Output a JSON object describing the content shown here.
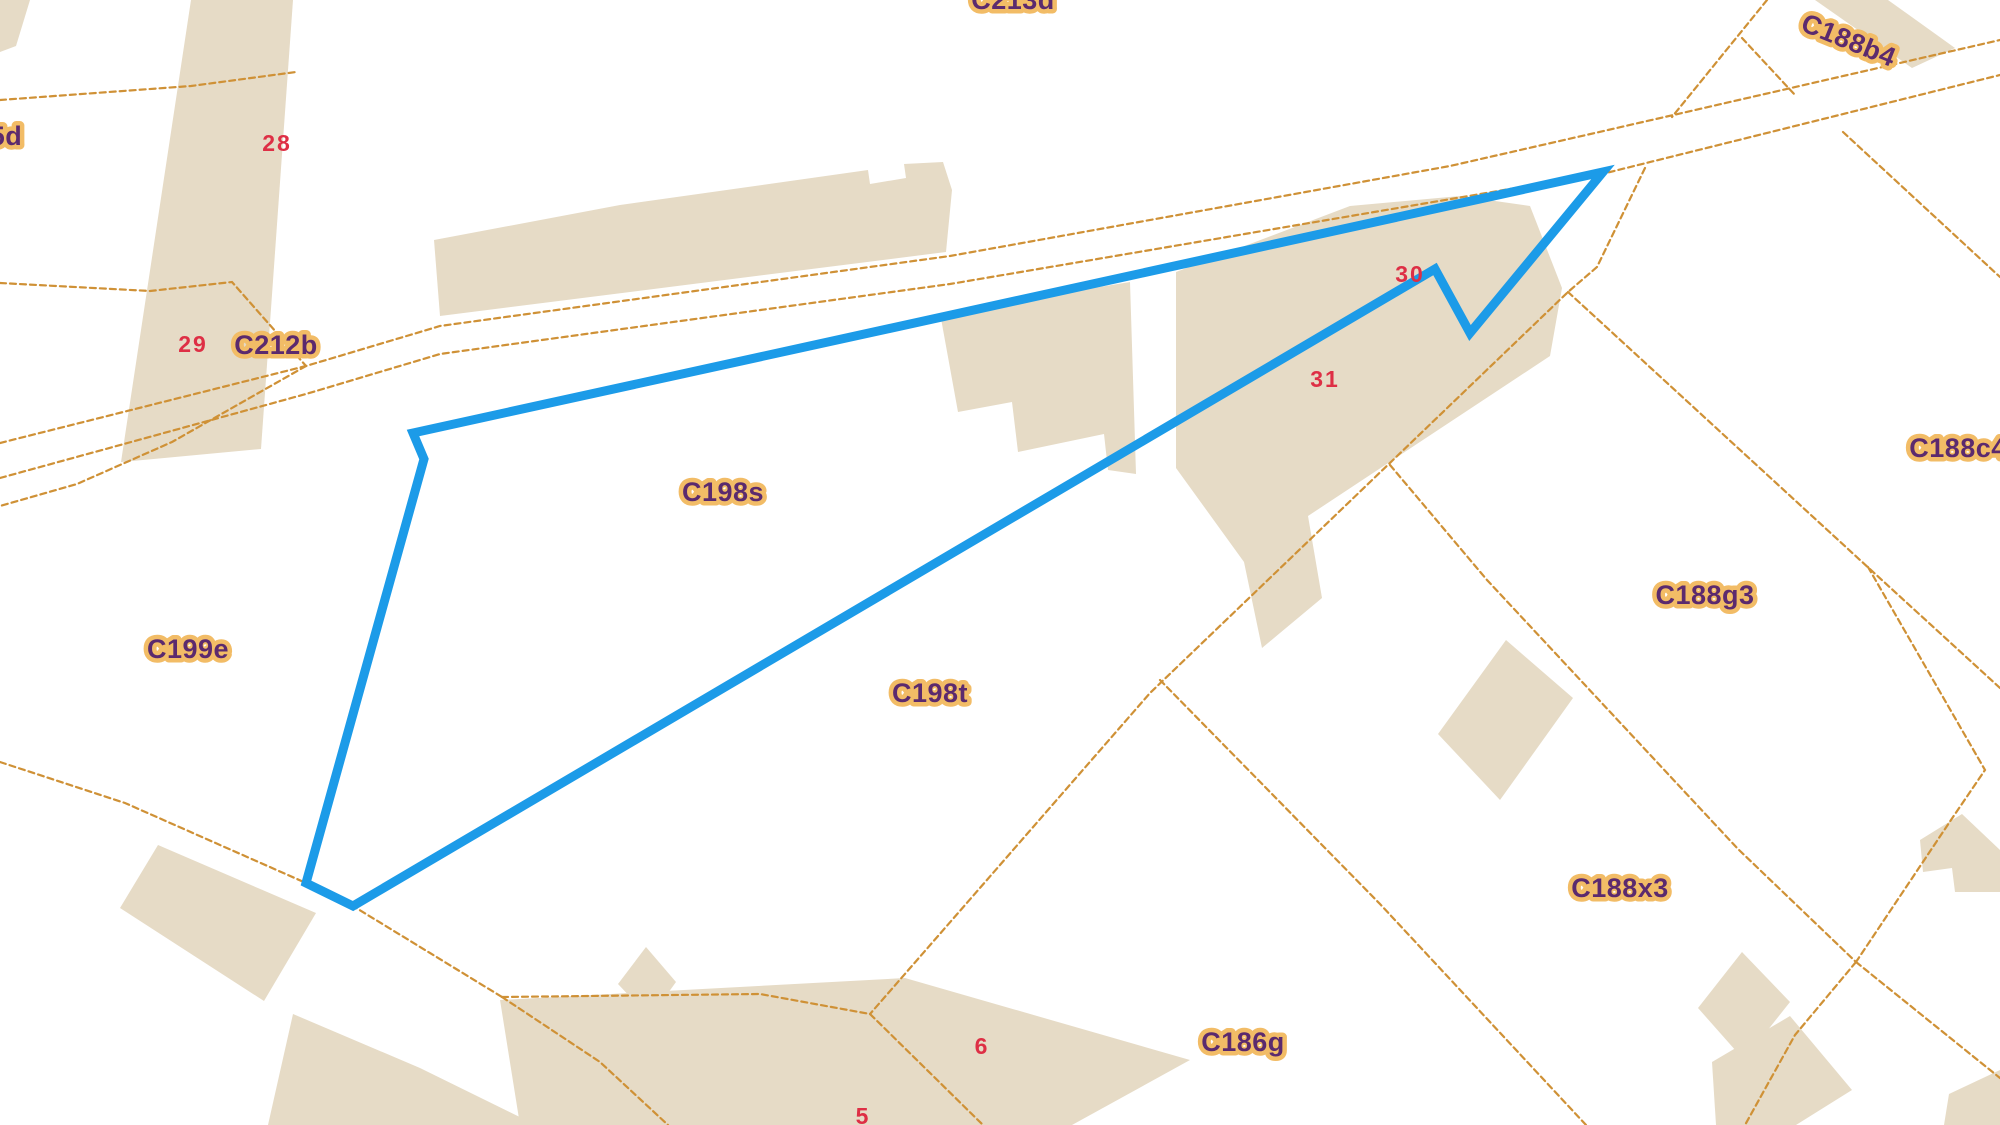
{
  "map": {
    "width": 2000,
    "height": 1125,
    "colors": {
      "background": "#ffffff",
      "building_fill": "#e6dbc6",
      "boundary_line": "#cf9136",
      "parcel_label": "#5b2a6e",
      "parcel_label_halo": "#f2bc66",
      "number_label": "#de2f45",
      "highlight": "#1c9be8"
    },
    "highlight": {
      "name": "selected-parcel-highlight",
      "points": "413,433 1603,172 1470,333 1435,269 353,906 306,883 424,459",
      "stroke_width": 9
    },
    "buildings": [
      {
        "name": "building-topleft-corner",
        "points": "0,0 30,0 16,46 0,52"
      },
      {
        "name": "building-strip-c212",
        "points": "191,0 293,0 261,449 121,462"
      },
      {
        "name": "building-long-row-north",
        "points": "434,240 620,205 868,170 870,184 906,178 904,164 943,162 952,190 946,252 440,316"
      },
      {
        "name": "building-cluster-west",
        "points": "940,313 1130,282 1136,474 1108,470 1104,434 1018,452 1012,402 958,412"
      },
      {
        "name": "building-cluster-east",
        "points": "1176,272 1350,206 1460,196 1530,206 1562,288 1550,356 1308,516 1322,598 1262,648 1244,562 1176,468"
      },
      {
        "name": "building-c188b4-band",
        "points": "1815,0 1888,0 1955,48 1912,68"
      },
      {
        "name": "building-diamond-c188g3",
        "points": "1506,640 1573,698 1500,800 1438,734"
      },
      {
        "name": "building-small-square",
        "points": "646,947 676,982 650,1018 618,984"
      },
      {
        "name": "building-bottomleft",
        "points": "158,845 316,913 264,1001 120,908"
      },
      {
        "name": "building-bottomleft-wedge",
        "points": "293,1014 420,1068 536,1125 268,1125"
      },
      {
        "name": "building-c186g-large",
        "points": "500,1000 905,978 1190,1060 1072,1125 520,1125"
      },
      {
        "name": "building-diamond-c188x3",
        "points": "1742,952 1790,1002 1744,1060 1698,1008"
      },
      {
        "name": "building-bottomright-mid",
        "points": "1712,1062 1790,1016 1852,1090 1796,1125 1716,1125"
      },
      {
        "name": "building-right-edge-notched",
        "points": "1920,840 1962,814 2000,850 2000,892 1955,892 1952,868 1923,872"
      },
      {
        "name": "building-bottomright-corner",
        "points": "1949,1094 2000,1070 2000,1125 1944,1125"
      }
    ],
    "boundaries": [
      {
        "name": "boundary-nw-1",
        "points": "0,100 191,86 296,72"
      },
      {
        "name": "boundary-nw-2",
        "points": "0,283 150,291 232,282 306,366"
      },
      {
        "name": "boundary-road-upper",
        "points": "0,443 306,366 440,326 950,256 1450,166 1608,130 2000,40"
      },
      {
        "name": "boundary-road-lower",
        "points": "0,478 306,394 440,354 950,284 1610,172 2000,75"
      },
      {
        "name": "boundary-c199e-north",
        "points": "306,366 172,442 77,484 0,506"
      },
      {
        "name": "boundary-c199e-south",
        "points": "0,762 125,803 306,883 353,906 502,997"
      },
      {
        "name": "boundary-sw-branch",
        "points": "502,997 600,1062 668,1125"
      },
      {
        "name": "boundary-c186g-north",
        "points": "502,997 760,994 870,1014 983,1125"
      },
      {
        "name": "boundary-c198t-east",
        "points": "1645,168 1597,267 1568,292 1393,460 1150,693 870,1014"
      },
      {
        "name": "boundary-c188g3-north",
        "points": "1568,292 1860,560 2000,688"
      },
      {
        "name": "boundary-c188c4-west",
        "points": "1843,132 2000,277"
      },
      {
        "name": "boundary-topright-1",
        "points": "1767,0 1672,117"
      },
      {
        "name": "boundary-topright-2",
        "points": "1742,38 1795,95"
      },
      {
        "name": "boundary-c188x3-north",
        "points": "1390,465 1487,580 1738,849 1856,962"
      },
      {
        "name": "boundary-c188x3-south",
        "points": "1160,680 1380,904 1586,1125"
      },
      {
        "name": "boundary-right-parcel",
        "points": "1868,567 1985,770 1953,817 1856,962"
      },
      {
        "name": "boundary-se-branch-1",
        "points": "1856,962 1795,1035 1745,1125"
      },
      {
        "name": "boundary-se-branch-2",
        "points": "1856,962 2000,1078"
      }
    ],
    "labels": [
      {
        "id": "c213d",
        "text": "C213d",
        "x": 1013,
        "y": 2,
        "kind": "parcel",
        "rot": 0
      },
      {
        "id": "c188b4",
        "text": "C188b4",
        "x": 1848,
        "y": 42,
        "kind": "parcel",
        "rot": 22
      },
      {
        "id": "c215d",
        "text": "5d",
        "x": 6,
        "y": 138,
        "kind": "parcel",
        "rot": 0
      },
      {
        "id": "n28",
        "text": "28",
        "x": 277,
        "y": 145,
        "kind": "number",
        "rot": 0
      },
      {
        "id": "n29",
        "text": "29",
        "x": 193,
        "y": 346,
        "kind": "number",
        "rot": 0
      },
      {
        "id": "c212b",
        "text": "C212b",
        "x": 276,
        "y": 347,
        "kind": "parcel",
        "rot": 0
      },
      {
        "id": "c198s",
        "text": "C198s",
        "x": 723,
        "y": 494,
        "kind": "parcel",
        "rot": 0
      },
      {
        "id": "c199e",
        "text": "C199e",
        "x": 188,
        "y": 651,
        "kind": "parcel",
        "rot": 0
      },
      {
        "id": "c198t",
        "text": "C198t",
        "x": 930,
        "y": 695,
        "kind": "parcel",
        "rot": 0
      },
      {
        "id": "n30",
        "text": "30",
        "x": 1410,
        "y": 276,
        "kind": "number",
        "rot": 0
      },
      {
        "id": "n31",
        "text": "31",
        "x": 1325,
        "y": 381,
        "kind": "number",
        "rot": 0
      },
      {
        "id": "c188c4",
        "text": "C188c4",
        "x": 1958,
        "y": 450,
        "kind": "parcel",
        "rot": 0
      },
      {
        "id": "c188g3",
        "text": "C188g3",
        "x": 1705,
        "y": 597,
        "kind": "parcel",
        "rot": 0
      },
      {
        "id": "c188x3",
        "text": "C188x3",
        "x": 1620,
        "y": 890,
        "kind": "parcel",
        "rot": 0
      },
      {
        "id": "c186g",
        "text": "C186g",
        "x": 1243,
        "y": 1044,
        "kind": "parcel",
        "rot": 0
      },
      {
        "id": "n6",
        "text": "6",
        "x": 982,
        "y": 1048,
        "kind": "number",
        "rot": 0
      },
      {
        "id": "n5",
        "text": "5",
        "x": 863,
        "y": 1118,
        "kind": "number",
        "rot": 0
      }
    ]
  }
}
